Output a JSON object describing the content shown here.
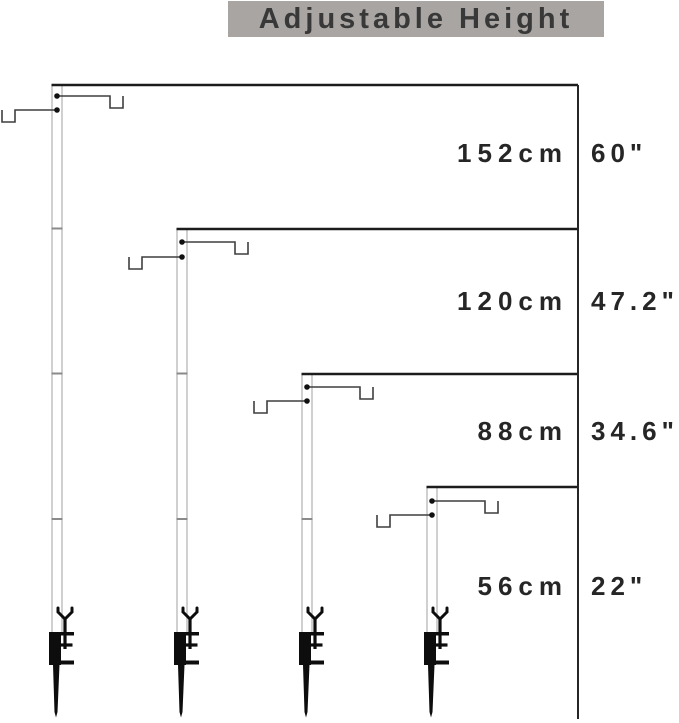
{
  "title": "Adjustable Height",
  "measurements": [
    {
      "label_cm": "152cm",
      "label_inch": "60\"",
      "cm": 152,
      "inch": 60
    },
    {
      "label_cm": "120cm",
      "label_inch": "47.2\"",
      "cm": 120,
      "inch": 47.2
    },
    {
      "label_cm": "88cm",
      "label_inch": "34.6\"",
      "cm": 88,
      "inch": 34.6
    },
    {
      "label_cm": "56cm",
      "label_inch": "22\"",
      "cm": 56,
      "inch": 22
    }
  ],
  "diagram": {
    "type": "adjustable-pole-height-diagram",
    "pole_count": 4,
    "poles": [
      {
        "name": "pole-152cm",
        "hooks": 2,
        "segment_joints": 3
      },
      {
        "name": "pole-120cm",
        "hooks": 2,
        "segment_joints": 2
      },
      {
        "name": "pole-88cm",
        "hooks": 2,
        "segment_joints": 1
      },
      {
        "name": "pole-56cm",
        "hooks": 2,
        "segment_joints": 0
      }
    ],
    "base": "clamp-with-ground-spike"
  },
  "colors": {
    "background": "#ffffff",
    "banner_bg": "#a8a5a2",
    "title_text": "#383838",
    "label_text": "#262626",
    "line_dark": "#1c1c1c",
    "pole_outline": "#b0b0b0",
    "hook_line": "#3f3f3f",
    "hardware_black": "#0d0d0d"
  }
}
